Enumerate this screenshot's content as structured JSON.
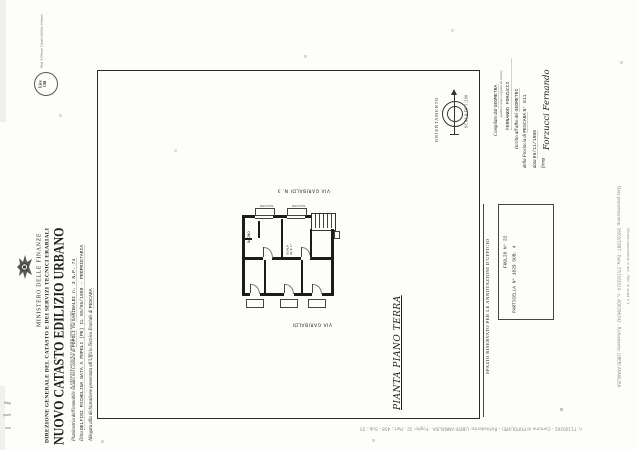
{
  "document": {
    "mod_label": "Mod. 8 (Nuovo Catasto Edilizio Urbano)",
    "header": {
      "ministry": "MINISTERO DELLE FINANZE",
      "directorate": "DIREZIONE GENERALE DEL CATASTO E DEI SERVIZI TECNICI ERARIALI",
      "title": "NUOVO CATASTO EDILIZIO URBANO",
      "law_reference": "R. DECRETO-LEGGE 13 APRILE 1939-XVII, N. 652",
      "stamp_line1": "Lire",
      "stamp_line2": "150"
    },
    "declaration": {
      "line1_label_a": "Planimetria dell'immobile situato nel Comune di",
      "line1_value_a": "POPOLI",
      "line1_label_b": "Via",
      "line1_value_b": "GARIBALDI  n. 3  N.P. 74",
      "line2_label": "Ditta",
      "line2_value": "DELFINI MICHELINA  NATA A POPOLI (PE) IL 09/05/1908  -  PROPRIETARIA",
      "line3_label": "Allegata alla dichiarazione presentata all'Ufficio Tecnico Erariale di",
      "line3_value": "PESCARA"
    },
    "drawing": {
      "orientation_label": "ORIENTAMENTO",
      "scale_label": "SCALA DI 1:200",
      "plan_title": "PIANTA  PIANO TERRA",
      "street_top": "VIA GARIBALDI N. 3",
      "street_bottom": "VIA GARIBALDI",
      "labels": {
        "bathroom": "BAGNO",
        "stairs_line1": "SCALA",
        "stairs_line2": "AL P. 1°",
        "balcony_left": "BALCONE",
        "balcony_right": "BALCONE"
      }
    },
    "surveyor": {
      "compiled_by_label": "Compilato dal",
      "title_value": "GEOMETRA",
      "note": "(qualifica, nome e cognome del tecnico)",
      "name_value": "FERNANDO FORZUCCI",
      "register_label": "Iscritto all'albo dei",
      "register_value": "GEOMETRI",
      "province_label": "della Provincia di",
      "province_value": "PESCARA",
      "register_number": "N° 611",
      "date_label": "data",
      "date_value": "09/11/1986",
      "signature_label": "firma",
      "signature_value": "Forzucci Fernando"
    },
    "office": {
      "reserved_label": "SPAZIO RISERVATO PER LE ANNOTAZIONI D'UFFICIO",
      "sheet": "FOGLIO N° 22",
      "parcel": "PARTICELLA N° 1829  SUB. 4"
    },
    "watermarks": {
      "bottom_strip": "n. T1100261 - Comune di POPOLI(PE) - Richiedente: LIBERI ANNALISA - Foglio: 32 - Part.: 458 - Sub.: 25",
      "right_edge_1": "Data presentazione: 26/02/1987 - Data: 27/10/2014 - n. AQ0296342 - Richiedente: LIBERI ANNALISA",
      "right_edge_2": "Ultima planimetria in atti - Fatt. di scala 1:1"
    }
  },
  "colors": {
    "ink": "#1d1d1b",
    "paper": "#fdfdfc",
    "watermark": "#8c8c8c"
  }
}
